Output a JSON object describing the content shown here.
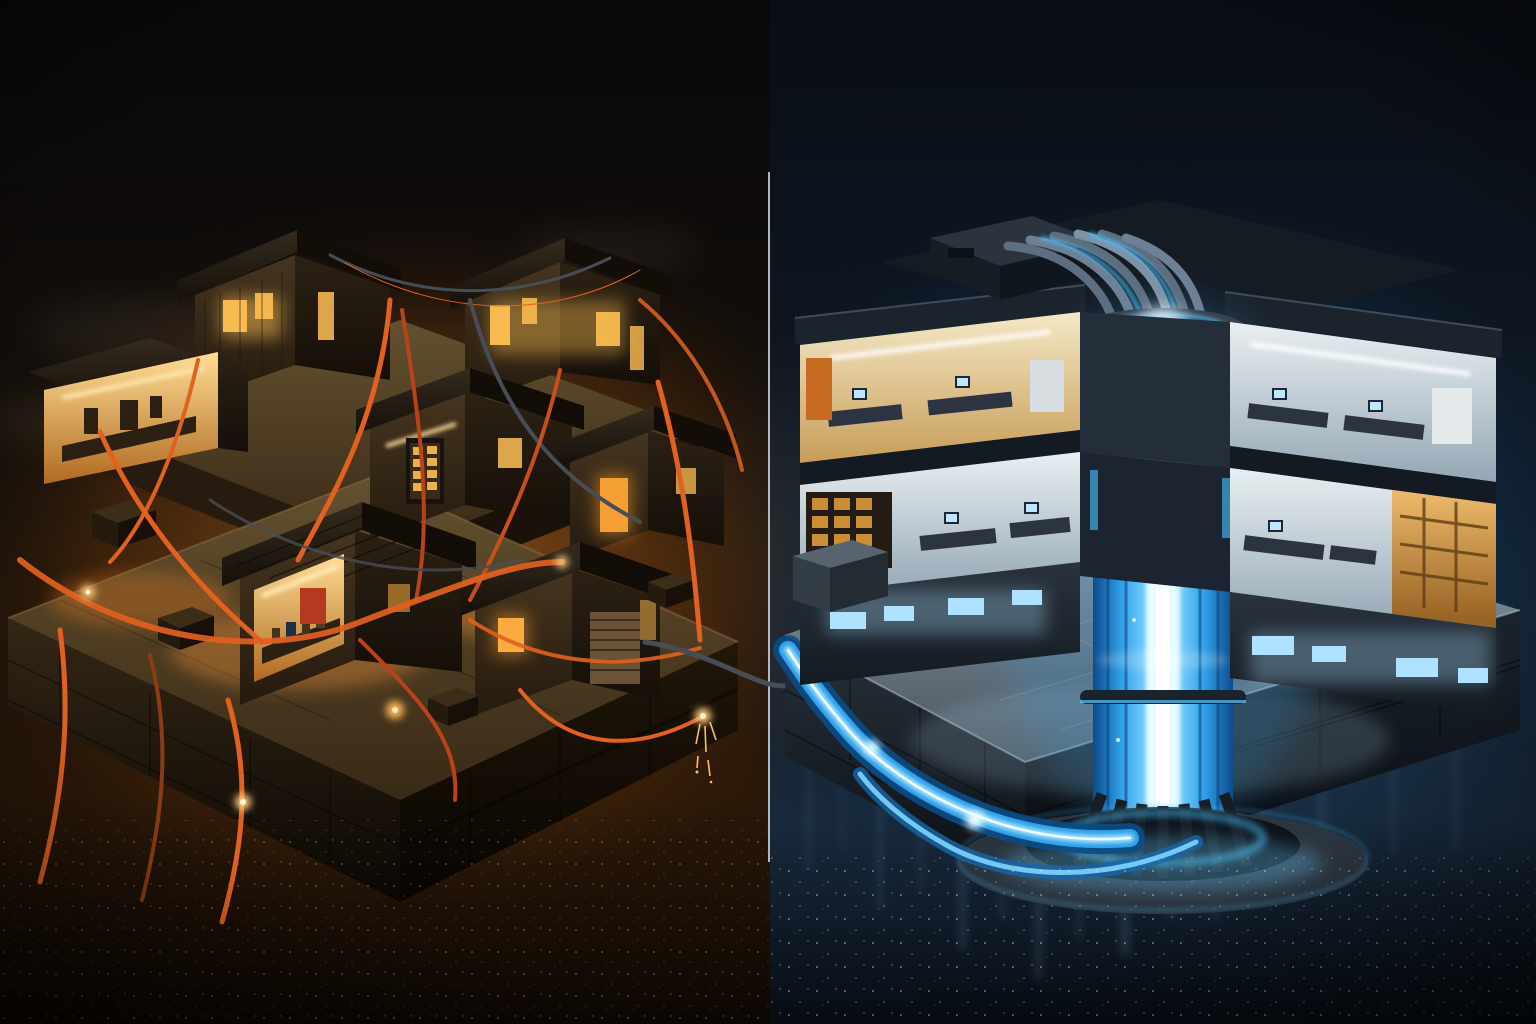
{
  "artwork": {
    "kind": "isometric split-scene digital illustration, night",
    "left_scene": {
      "label": "ramshackle wooden shanty compound",
      "lighting": "warm orange",
      "elements": [
        "wooden shacks",
        "glowing amber windows",
        "open workshop interiors",
        "tangled orange cables",
        "hanging frayed cables with sparks",
        "cracked concrete plinth",
        "crates and barrels",
        "smoke haze",
        "ember-speckled ground"
      ]
    },
    "right_scene": {
      "label": "futuristic cutaway office building with central energy column",
      "lighting": "cool blue",
      "elements": [
        "flat dark roofs",
        "rooftop penthouse block",
        "cable bundle into column collar",
        "glowing blue energy column",
        "ribbed column base with glow ring",
        "blue light-stream conduits across plaza",
        "two cutaway office floors",
        "desks with glowing monitors",
        "amber-lit archive room",
        "blue ground-floor windows",
        "reflective tiled plaza",
        "slate block plinth",
        "wet ground with light reflections"
      ]
    },
    "divider": {
      "label": "thin vertical light seam between the two halves"
    },
    "link_cable": {
      "label": "dark cable crossing from left plinth to right plinth"
    }
  },
  "palette": {
    "left_sky": "#0a090c",
    "left_horizon_glow": "#ff9632",
    "shack_wood": "#3b2d1c",
    "window_warm": "#ffc052",
    "interior_warm": "#ffd98c",
    "cable_orange": "#e2611f",
    "cable_dark": "#474d56",
    "spark": "#ffcf82",
    "concrete": "#5c4930",
    "right_sky": "#0a0e15",
    "right_glow": "#4fb4ff",
    "building_shell": "#232d37",
    "plaza_tile": "#8494a0",
    "column_body": "#2f9fe8",
    "column_core": "#e8fcff",
    "window_cool": "#aee2ff",
    "interior_cream": "#f2e6c4",
    "interior_cool": "#e6edf0",
    "divider": "#cdd6de"
  }
}
